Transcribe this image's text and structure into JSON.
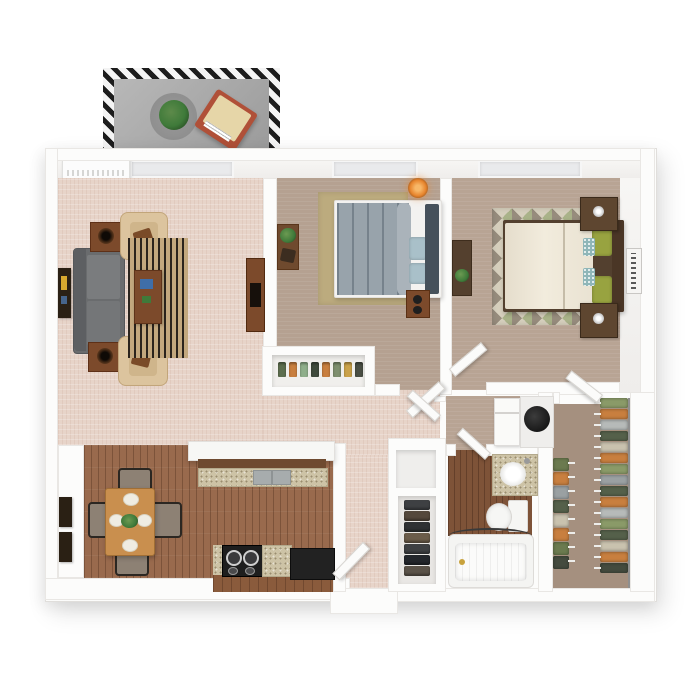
{
  "palette": {
    "wall": "#fcfcfb",
    "wallEdge": "#e9e7e4",
    "carpetLiving": "#e7d4c9",
    "carpetBedroom": "#b5a191",
    "carpetMaster": "#b8a494",
    "carpetCloset": "#a5907f",
    "woodFloor": "#996a4d",
    "woodDark": "#7e5338",
    "balconyFloor": "#a8a8a8",
    "balconyRug": "#8f8f8f",
    "sofaGray": "#6a6c6e",
    "armchairCream": "#dcc49e",
    "rugTan": "#c3a87e",
    "rugStripe": "#2b241d",
    "woodFurniture": "#7c4a2b",
    "diningWood": "#c98f4e",
    "graniteTone": "#cdc3a6",
    "cabinetWood": "#8a5b3c",
    "stoveBlack": "#1e1e1e",
    "bedBlue": "#98a3ab",
    "pillowBlue": "#a9c0c9",
    "headboardGray": "#46515b",
    "duvetCream": "#ece5d5",
    "pillowGreen": "#98a340",
    "pillowTeal": "#8fb6b8",
    "headboardBrown": "#53402f",
    "nightstandBrown": "#5e4630",
    "lampOrange": "#e8862e",
    "porcelain": "#f6f6f4",
    "heaterBlack": "#181818",
    "plantGreen": "#3f7a3a",
    "accentRed": "#b05038",
    "artDark": "#2a2014",
    "chairDark": "#2b2722",
    "chairCushion": "#8d8174",
    "bedroomRug": "#bcab7e",
    "diamondGreen": "#a9b289",
    "diamondBrown": "#978c7d",
    "diamondBase": "#d6cfbd"
  },
  "racks": {
    "walk_in_right": [
      "#8a9a68",
      "#c87f3f",
      "#b6bab9",
      "#55604a",
      "#c9c2ae",
      "#c87f3f",
      "#8a9a68",
      "#9aa0a2",
      "#55604a",
      "#c87f3f",
      "#b6bab9",
      "#8a9a68",
      "#55604a",
      "#c9c2ae",
      "#c87f3f",
      "#444b3e"
    ],
    "walk_in_left": [
      "#6b7a4f",
      "#c87f3f",
      "#9aa0a2",
      "#55604a",
      "#c9c2ae",
      "#c87f3f",
      "#6b7a4f",
      "#444b3e"
    ],
    "coat_closet_shoes": [
      "#3e4043",
      "#54483c",
      "#2f3133",
      "#6b5c4a",
      "#3e4043",
      "#23262b",
      "#5a5248"
    ],
    "bedroom_closet_shoes": [
      "#5d6e4e",
      "#c87f3f",
      "#8fae8a",
      "#3f4a3c",
      "#c87f3f",
      "#7e8f6e",
      "#caa24a",
      "#4a4f45"
    ]
  }
}
